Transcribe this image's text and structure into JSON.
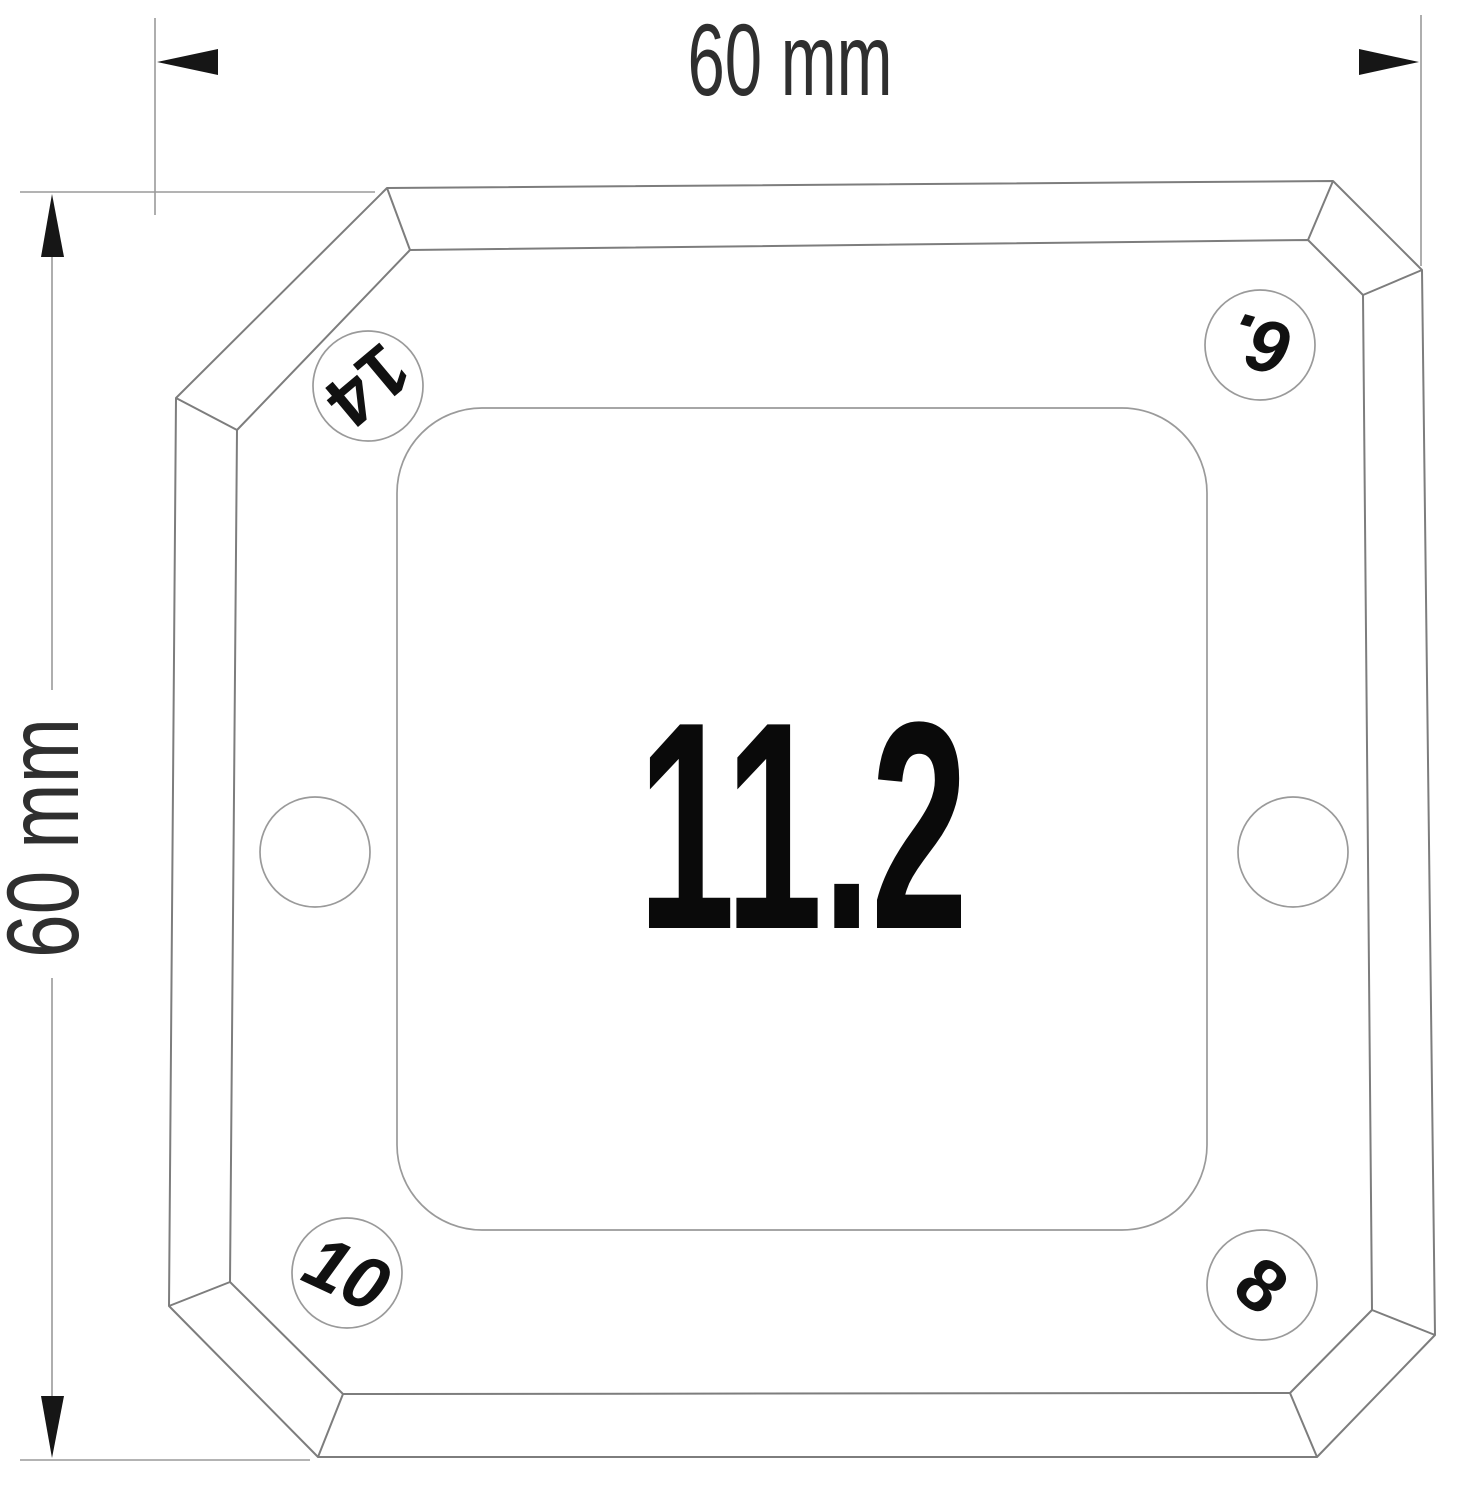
{
  "colors": {
    "outline": "#7d7d7d",
    "thin_line": "#9a9a9a",
    "arrow": "#161616",
    "dim_text": "#2f2f2f",
    "label_text": "#111111",
    "center_text": "#0a0a0a"
  },
  "dimensions": {
    "top": {
      "label": "60 mm"
    },
    "left": {
      "label": "60 mm"
    }
  },
  "center_value": "11.2",
  "hole_labels": {
    "top_left": "14",
    "top_right": "6.",
    "bottom_left": "10",
    "bottom_right": "8"
  }
}
